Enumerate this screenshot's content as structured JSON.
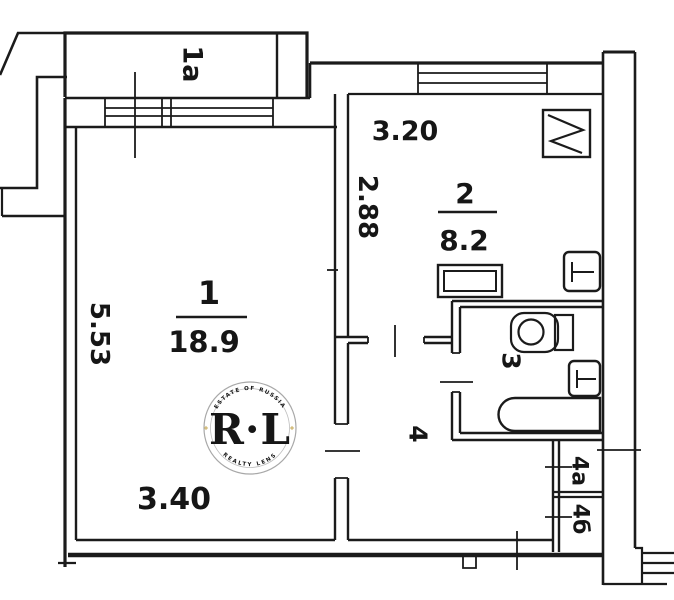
{
  "plan": {
    "balcony_label": "1а",
    "room1": {
      "number": "1",
      "area": "18.9",
      "width": "3.40",
      "height": "5.53"
    },
    "kitchen": {
      "number": "2",
      "area": "8.2",
      "width": "3.20",
      "height": "2.88"
    },
    "bathroom_label": "3",
    "hall_label": "4",
    "closet_a_label": "4а",
    "closet_b_label": "4б",
    "watermark": {
      "arc_top": "ESTATE OF RUSSIA",
      "initials": "R·L",
      "arc_bottom": "REALTY LENS",
      "gold": "#b8922a"
    },
    "colors": {
      "ink": "#1b1b1b",
      "paper": "#ffffff"
    }
  }
}
